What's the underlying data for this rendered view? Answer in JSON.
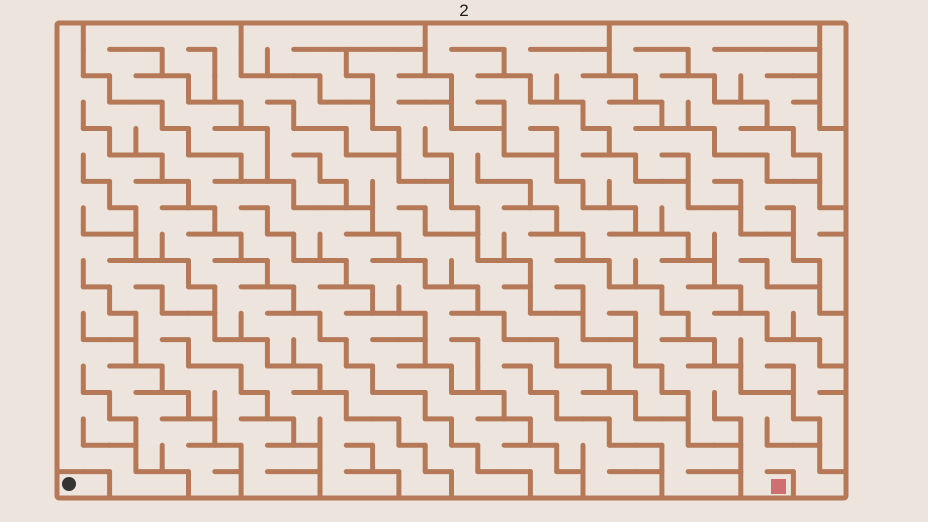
{
  "page": {
    "background": "#EDE5DD"
  },
  "hud": {
    "level_label": "2",
    "label_color": "#1B1B1B"
  },
  "maze": {
    "x": 57,
    "y": 23,
    "width": 789,
    "height": 475,
    "cols": 30,
    "rows": 18,
    "wall_color": "#B57958",
    "wall_thickness": 5,
    "cells": [
      ".CWWWWWCWWWWWWCWWWWWWCWWWWWWWC",
      "NNWWNWNNNWWCWWNWWNWWWNWWNWWWWN",
      "NWNWWNNWWWNWNWWNWWNNWWNWWNNWWN",
      "NNWWNWWNWNWWNWWNWNWWNWWNNWWNWN",
      "NWNNWNWWNWWNWNNWWNWNWNWWWNWWNW",
      "NNWWNWWNNWNWWNWNNWWNWWNWNWWNWN",
      "NWNWWNWWWNWNNWWNWWNWNNWWNWNWWN",
      "NNWNWWNWNWWWNWNWNWWNWWNNWWNWNW",
      "NWWNNWWNWNNWWNWWNNWWNWWWNNWWNW",
      "NNWWWNWWNWWNWWNNWWNWWNNWWNWNWN",
      "NWNWNWNWWNWWNNWWNWNWNWWNWWNWWN",
      "NNWNWWNNWWNWWWNWWNWWNWNWNWWNNW",
      "NWWNWNWWNNWNWWNWNWWNWWNWWNNWWN",
      "NNWWNWWNWWNWNWWNNWNWWNWNWWNWNW",
      "NWNWWNNWNWWNWWNWWNWNWWNWNNWWNW",
      "NNWNWWNWWNNWWNWNWWNWWNWWNWNNWN",
      "NWWNNWWNWWNWNWNWNWWNNWWNWWNWWN",
      "CWNWWNWNWWNWWNWNWWNWNWWNWWNWNW"
    ]
  },
  "player": {
    "shape": "circle",
    "color": "#343434",
    "cx": 69,
    "cy": 484,
    "r": 7
  },
  "goal": {
    "shape": "square",
    "color": "#CF6F72",
    "x": 771,
    "y": 479,
    "size": 15
  }
}
